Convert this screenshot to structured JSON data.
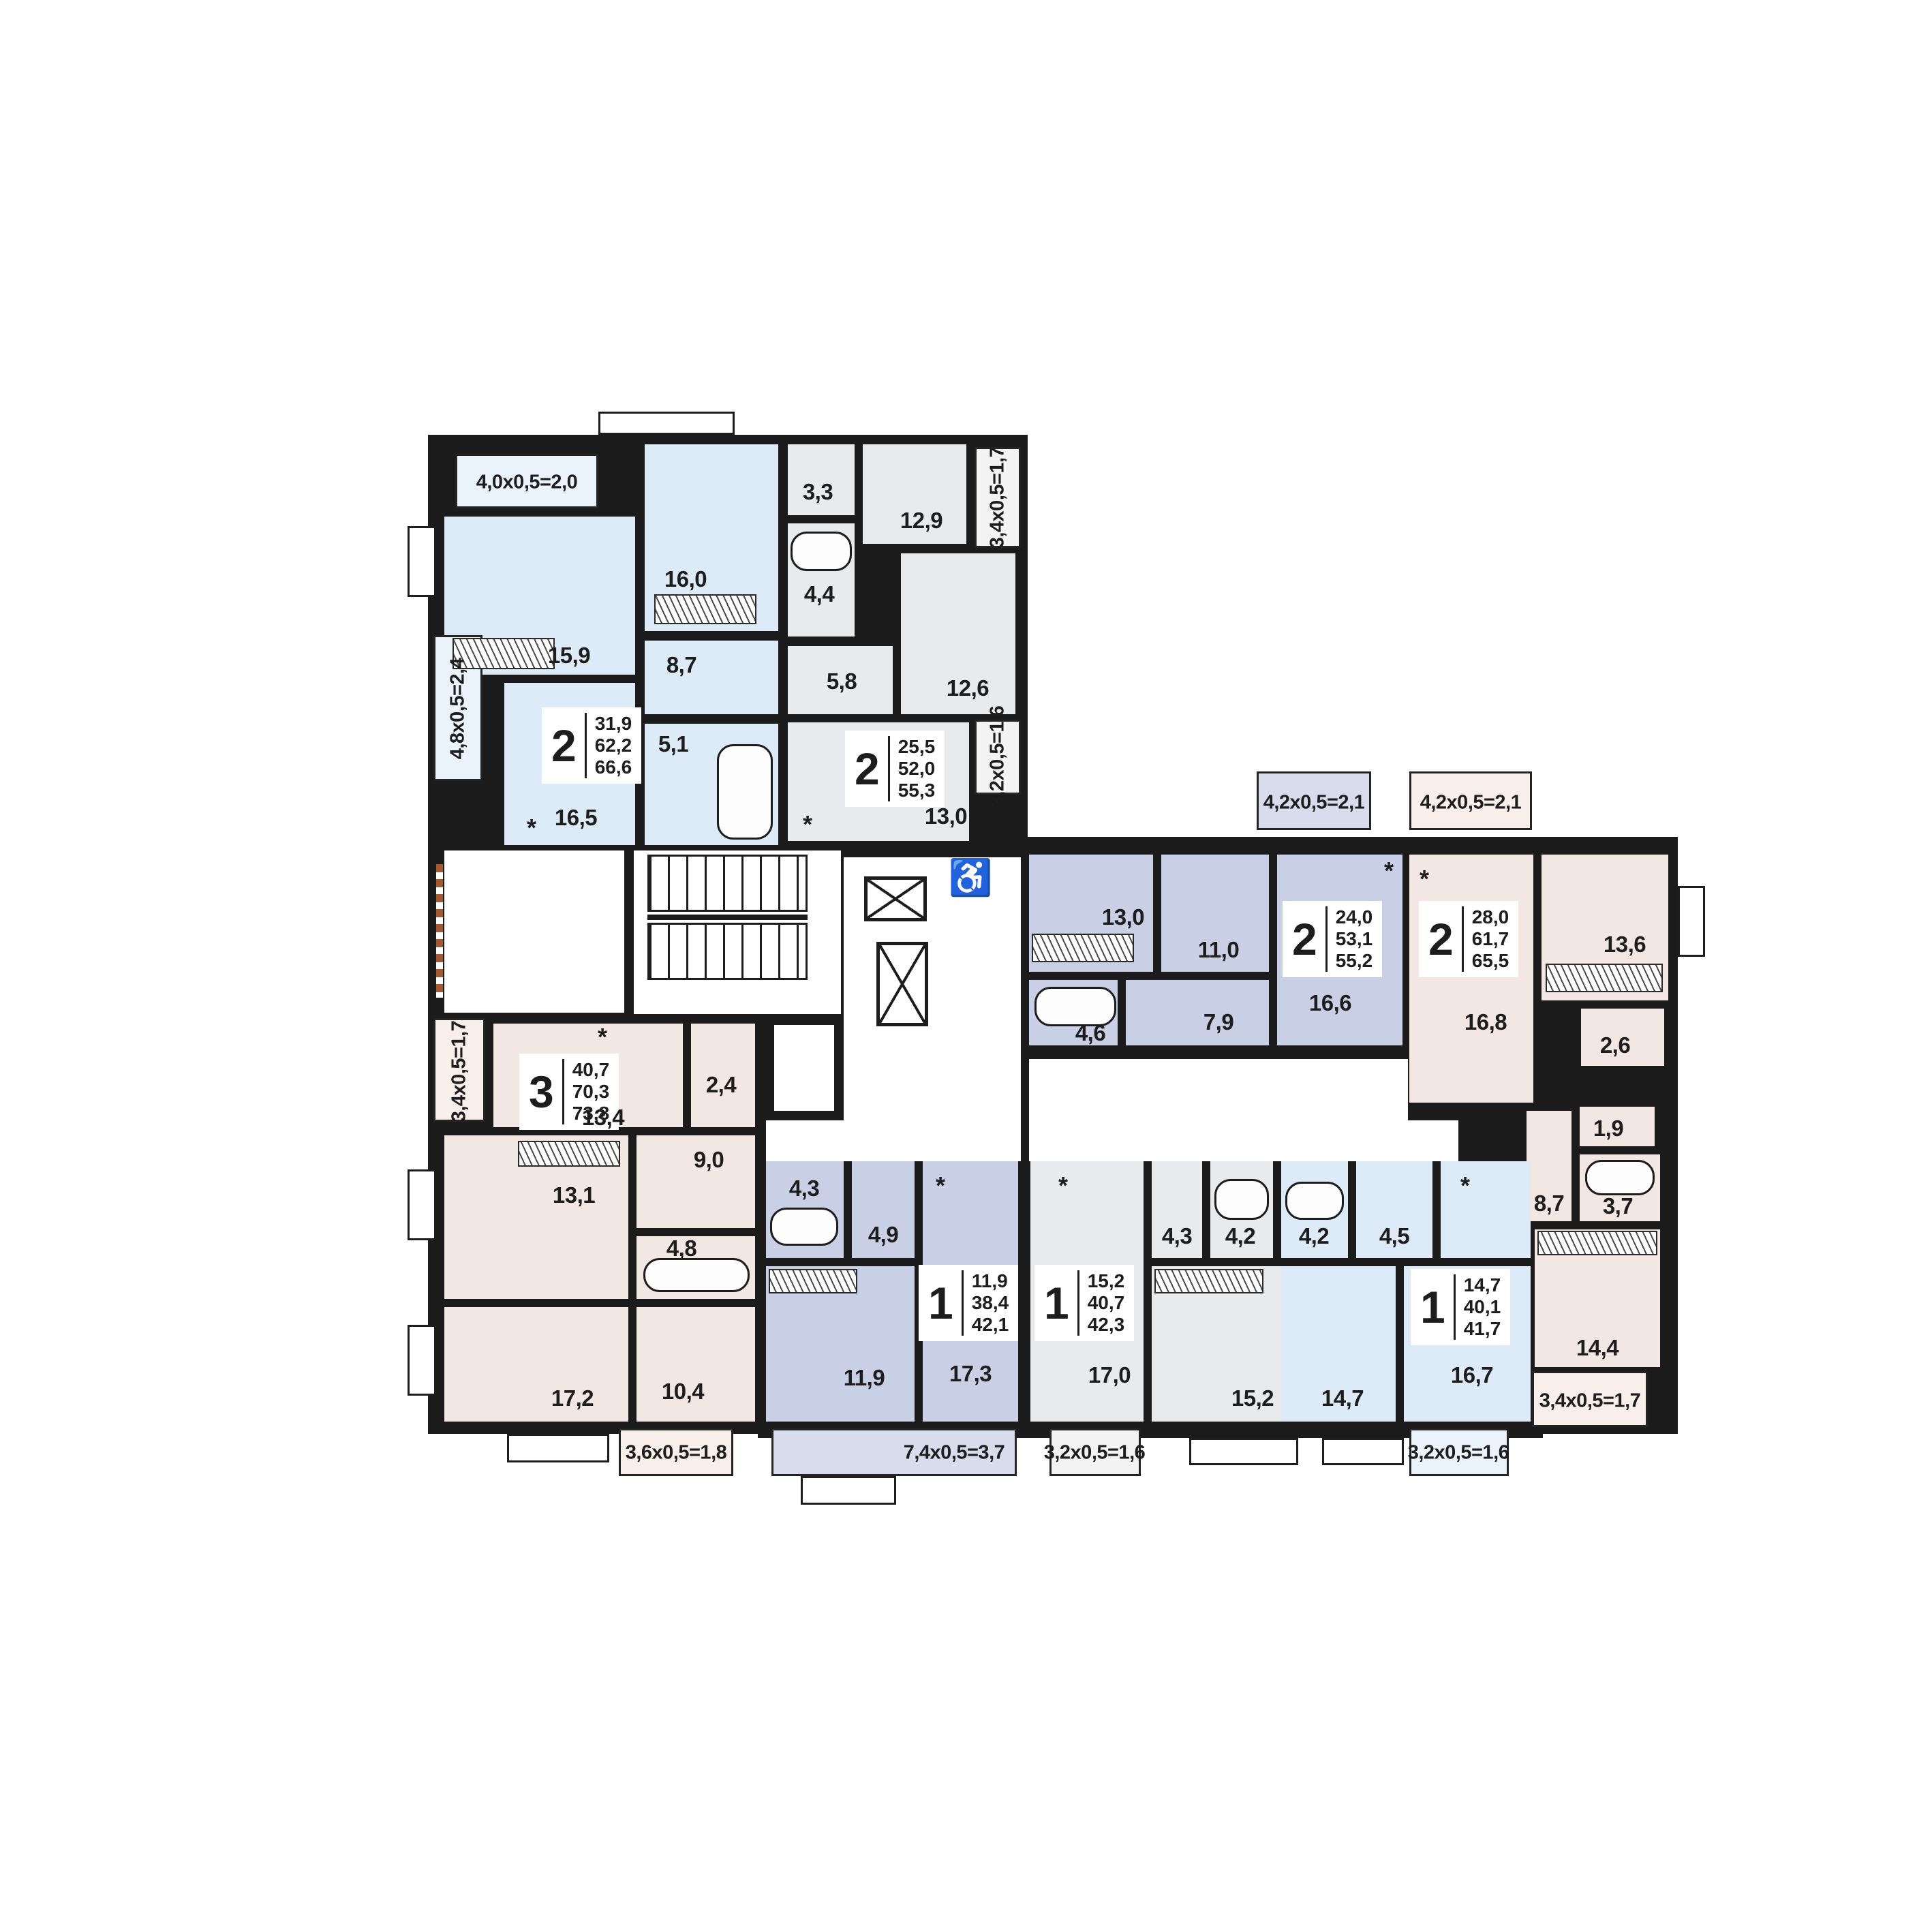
{
  "apartments": [
    {
      "id": "A",
      "type": "2",
      "areas": {
        "living": "31,9",
        "apartment": "62,2",
        "total": "66,6"
      },
      "rooms": {
        "living": "15,9",
        "bedroom": "16,0",
        "hall": "8,7",
        "kitchen": "16,5",
        "bath": "5,1"
      },
      "balconies": {
        "top": "4,0х0,5=2,0",
        "side": "4,8х0,5=2,4"
      }
    },
    {
      "id": "B",
      "type": "2",
      "areas": {
        "living": "25,5",
        "apartment": "52,0",
        "total": "55,3"
      },
      "rooms": {
        "closet": "3,3",
        "bath": "4,4",
        "bedroom1": "12,9",
        "hall": "5,8",
        "bedroom2": "12,6",
        "kitchen": "13,0"
      },
      "balconies": {
        "top": "3,4х0,5=1,7",
        "side": "3,2х0,5=1,6"
      }
    },
    {
      "id": "C",
      "type": "2",
      "areas": {
        "living": "24,0",
        "apartment": "53,1",
        "total": "55,2"
      },
      "rooms": {
        "bedroom1": "13,0",
        "bedroom2": "11,0",
        "bath": "4,6",
        "hall": "7,9",
        "kitchen": "16,6"
      },
      "balconies": {
        "top": "4,2х0,5=2,1"
      }
    },
    {
      "id": "D",
      "type": "2",
      "areas": {
        "living": "28,0",
        "apartment": "61,7",
        "total": "65,5"
      },
      "rooms": {
        "kitchen_living": "16,8",
        "bedroom1": "13,6",
        "closet": "2,6",
        "wc": "1,9",
        "bath": "3,7",
        "hall": "8,7",
        "bedroom2": "14,4"
      },
      "balconies": {
        "top": "4,2х0,5=2,1",
        "bottom": "3,4х0,5=1,7"
      }
    },
    {
      "id": "E",
      "type": "3",
      "areas": {
        "living": "40,7",
        "apartment": "70,3",
        "total": "73,8"
      },
      "rooms": {
        "kitchen_living": "13,4",
        "wc": "2,4",
        "hall": "9,0",
        "bath": "4,8",
        "bedroom1": "13,1",
        "bedroom2": "17,2",
        "bedroom3": "10,4"
      },
      "balconies": {
        "side": "3,4х0,5=1,7",
        "bottom": "3,6х0,5=1,8"
      }
    },
    {
      "id": "F",
      "type": "1",
      "areas": {
        "living": "11,9",
        "apartment": "38,4",
        "total": "42,1"
      },
      "rooms": {
        "bath": "4,3",
        "hall": "4,9",
        "bedroom": "11,9",
        "kitchen_living": "17,3"
      },
      "balconies": {
        "bottom": "7,4х0,5=3,7"
      }
    },
    {
      "id": "G",
      "type": "1",
      "areas": {
        "living": "15,2",
        "apartment": "40,7",
        "total": "42,3"
      },
      "rooms": {
        "kitchen_living": "17,0",
        "hall": "4,3",
        "bath": "4,2",
        "bedroom": "15,2"
      },
      "balconies": {
        "bottom": "3,2х0,5=1,6"
      }
    },
    {
      "id": "H",
      "type": "1",
      "areas": {
        "living": "14,7",
        "apartment": "40,1",
        "total": "41,7"
      },
      "rooms": {
        "bath": "4,2",
        "hall": "4,5",
        "bedroom": "14,7",
        "kitchen_living": "16,7"
      },
      "balconies": {
        "bottom": "3,2х0,5=1,6"
      }
    }
  ],
  "symbols": {
    "wheelchair": "♿",
    "fridge": "*"
  }
}
